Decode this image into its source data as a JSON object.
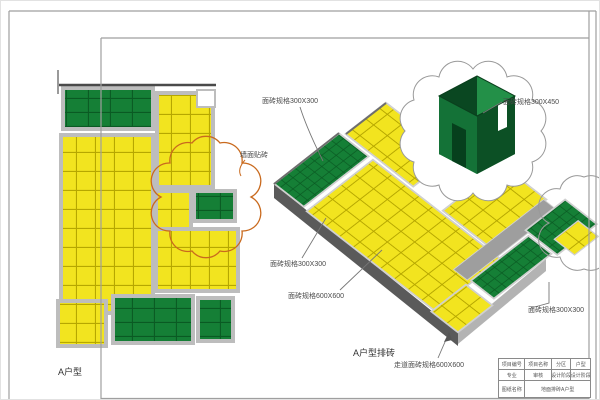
{
  "sheet": {
    "plan_title": "A户型",
    "iso_title": "A户型排砖",
    "labels": {
      "spec_top": "面砖规格300X300",
      "spec_box": "面砖规格300X450",
      "wall_tile": "墙面贴砖",
      "spec_left": "面砖规格300X300",
      "spec_600": "面砖规格600X600",
      "spec_right": "面砖规格300X300",
      "corridor": "走道面砖规格600X600"
    },
    "title_block": {
      "r1c1": "项目编号",
      "r1c2": "项目名称",
      "r1c3": "分区",
      "r1c4": "户型",
      "r2c1": "专业",
      "r2c2": "审核",
      "r2c3": "设计阶段",
      "r2c4": "设计阶段",
      "r3label": "图纸名称",
      "r3value": "地面排砖A户型"
    },
    "colors": {
      "tile_yellow": "#f2e41f",
      "tile_yellow_grid": "#b6a700",
      "tile_green": "#157f36",
      "tile_green_grid": "#0a5a23",
      "wall_gray": "#bdbdbd",
      "slab_dark": "#5a5a5a",
      "slab_light": "#b3b3b3",
      "revision_cloud_orange": "#c96a1e",
      "line_gray": "#9f9f9f"
    }
  }
}
